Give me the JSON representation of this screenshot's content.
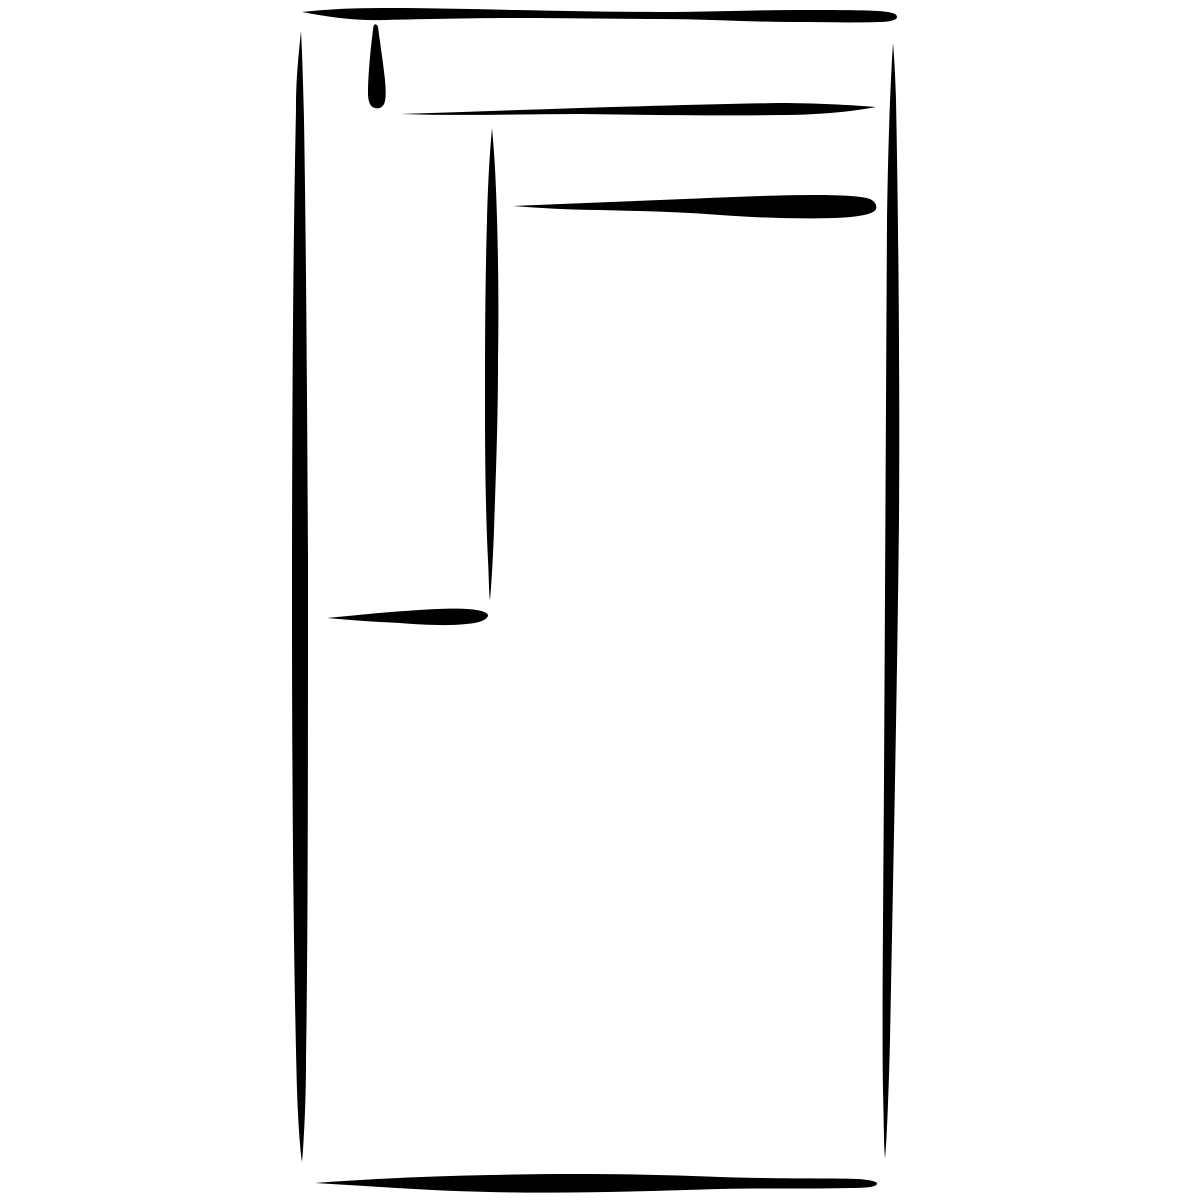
{
  "canvas": {
    "width": 1200,
    "height": 1200,
    "background_color": "#ffffff",
    "ink_color": "#000000"
  },
  "sketch": {
    "type": "freehand-ink-drawing",
    "subject": "tall rectangle outline with inner corner lines and small tick mark",
    "strokes": [
      {
        "name": "outer-top-edge",
        "path": "M302,12 C330,9 355,8 385,8 C430,8 470,9 515,10 C565,11 610,12 660,12 C710,12 755,10 800,10 C830,10 860,10 878,11 C890,12 897,13 897,17 C897,20 890,22 878,22 C850,23 820,22 795,22 C750,22 705,19 660,19 C615,19 570,18 520,18 C470,18 430,19 385,20 C355,21 328,17 302,12 Z"
      },
      {
        "name": "outer-left-edge",
        "path": "M301,31 C298,60 296,80 296,110 C293,250 292,420 292,600 C292,820 294,980 297,1090 C298,1120 300,1150 302,1162 C304,1140 306,1100 306,1060 C308,930 308,760 308,560 C307,380 306,240 304,120 C303,80 302,50 301,31 Z"
      },
      {
        "name": "outer-right-edge",
        "path": "M893,43 C890,90 888,150 887,220 C886,400 885,600 884,780 C883,930 882,1030 883,1090 C884,1130 884,1150 885,1158 C887,1140 889,1080 890,1040 C893,880 897,700 899,520 C900,360 898,200 896,100 C895,70 894,55 893,43 Z"
      },
      {
        "name": "outer-bottom-edge",
        "path": "M315,1183 C370,1179 430,1176 490,1175 C570,1173 650,1174 720,1177 C780,1179 830,1178 858,1179 C872,1180 878,1182 877,1184 C876,1187 866,1188 850,1188 C810,1189 770,1188 720,1189 C650,1191 570,1194 490,1192 C430,1191 370,1186 315,1183 Z"
      },
      {
        "name": "inner-tick-teardrop",
        "path": "M374,25 C375,24 377,24 378,27 C380,42 383,62 385,80 C386,92 386,100 384,104 C382,108 378,109 375,108 C370,107 368,101 368,93 C368,78 370,55 372,38 C373,31 373,27 374,25 Z"
      },
      {
        "name": "inner-upper-horizontal",
        "path": "M400,114 C460,112 520,110 580,108 C650,106 720,104 780,103 C815,103 850,105 876,107 C850,112 815,115 780,115 C720,116 650,115 580,114 C520,114 460,116 400,114 Z"
      },
      {
        "name": "inner-vertical",
        "path": "M492,128 C490,150 488,180 487,220 C485,290 485,350 485,410 C485,470 486,520 488,560 C489,580 489,595 490,600 C491,590 493,560 494,530 C496,470 498,420 498,360 C499,300 498,240 496,190 C495,160 493,140 492,128 Z"
      },
      {
        "name": "inner-lower-horizontal",
        "path": "M513,206 C560,204 610,202 660,200 C710,198 770,195 815,195 C840,195 862,196 870,199 C876,202 877,206 876,209 C874,214 860,217 835,218 C800,219 760,218 720,215 C680,212 640,211 600,210 C570,210 540,208 513,206 Z"
      },
      {
        "name": "inner-short-horizontal",
        "path": "M327,618 C350,616 375,613 405,611 C430,609 455,608 468,609 C480,610 487,612 488,615 C488,619 481,623 466,624 C448,626 425,625 400,623 C375,622 350,620 327,618 Z"
      }
    ]
  }
}
